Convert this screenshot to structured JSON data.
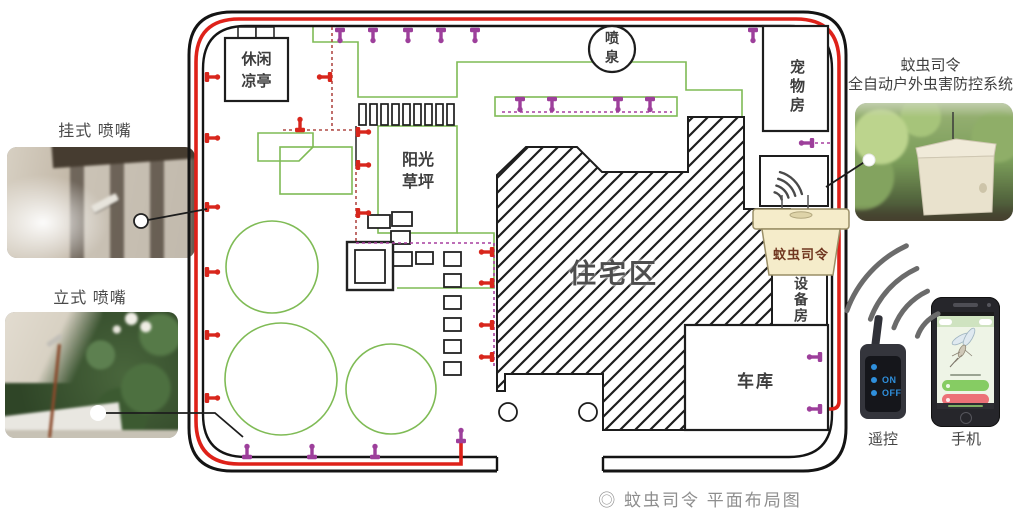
{
  "photos": {
    "hanging": {
      "label": "挂式 喷嘴"
    },
    "standing": {
      "label": "立式 喷嘴"
    }
  },
  "system": {
    "title_line1": "蚊虫司令",
    "title_line2": "全自动户外虫害防控系统"
  },
  "plan": {
    "pavilion": "休闲\n凉亭",
    "fountain": "喷\n泉",
    "pet_room": "宠物房",
    "lawn": "阳光\n草坪",
    "residential": "住宅区",
    "device": "蚊虫司令",
    "equipment_room": "设备房",
    "garage": "车库"
  },
  "controls": {
    "remote_label": "遥控",
    "phone_label": "手机",
    "remote_on": "ON",
    "remote_off": "OFF"
  },
  "caption": "◎ 蚊虫司令 平面布局图",
  "icons": {
    "red_nozzle": "red-nozzle-pin",
    "purple_nozzle": "purple-nozzle-pin",
    "wifi": "wifi-signal-arcs"
  },
  "colors": {
    "pipe_red": "#de2119",
    "nozzle_purple": "#9d3f9b",
    "lawn_green": "#7fbb55",
    "device_cream": "#f5ecca",
    "wall_black": "#141414",
    "caption_gray": "#8e8e8e"
  }
}
